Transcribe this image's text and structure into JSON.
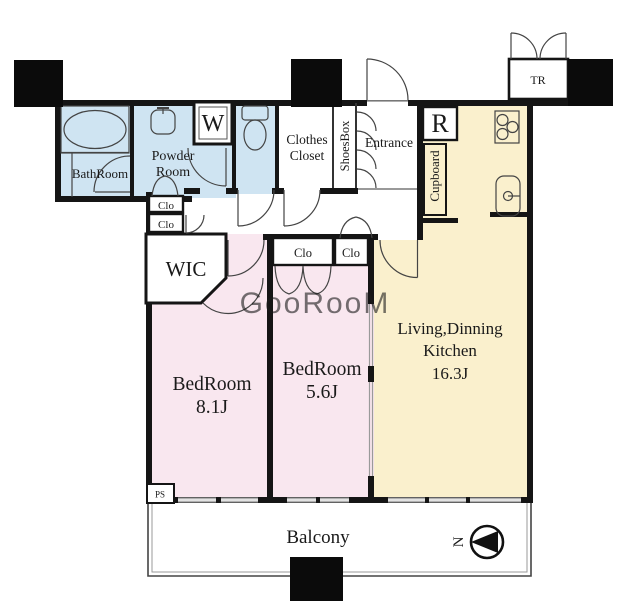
{
  "colors": {
    "wet_area": "#cfe4f2",
    "bedroom": "#f9e7ef",
    "ldk": "#faf0cd",
    "wall": "#151515",
    "window": "#b0b0b0"
  },
  "rooms": {
    "bathroom": {
      "label": "BathRoom"
    },
    "powder_room": {
      "line1": "Powder",
      "line2": "Room"
    },
    "washer": {
      "label": "W"
    },
    "clothes_closet": {
      "line1": "Clothes",
      "line2": "Closet"
    },
    "shoes_box": {
      "label": "ShoesBox"
    },
    "entrance": {
      "label": "Entrance"
    },
    "refrigerator": {
      "label": "R"
    },
    "cupboard": {
      "label": "Cupboard"
    },
    "trunk_room": {
      "label": "TR"
    },
    "wic": {
      "label": "WIC"
    },
    "closet": {
      "label": "Clo"
    },
    "bedroom1": {
      "name": "BedRoom",
      "size": "8.1J"
    },
    "bedroom2": {
      "name": "BedRoom",
      "size": "5.6J"
    },
    "ldk": {
      "line1": "Living,Dinning",
      "line2": "Kitchen",
      "size": "16.3J"
    },
    "balcony": {
      "label": "Balcony"
    },
    "pipe_space": {
      "label": "PS"
    }
  },
  "compass": {
    "label": "N"
  },
  "watermark": {
    "text": "GooRooM"
  }
}
